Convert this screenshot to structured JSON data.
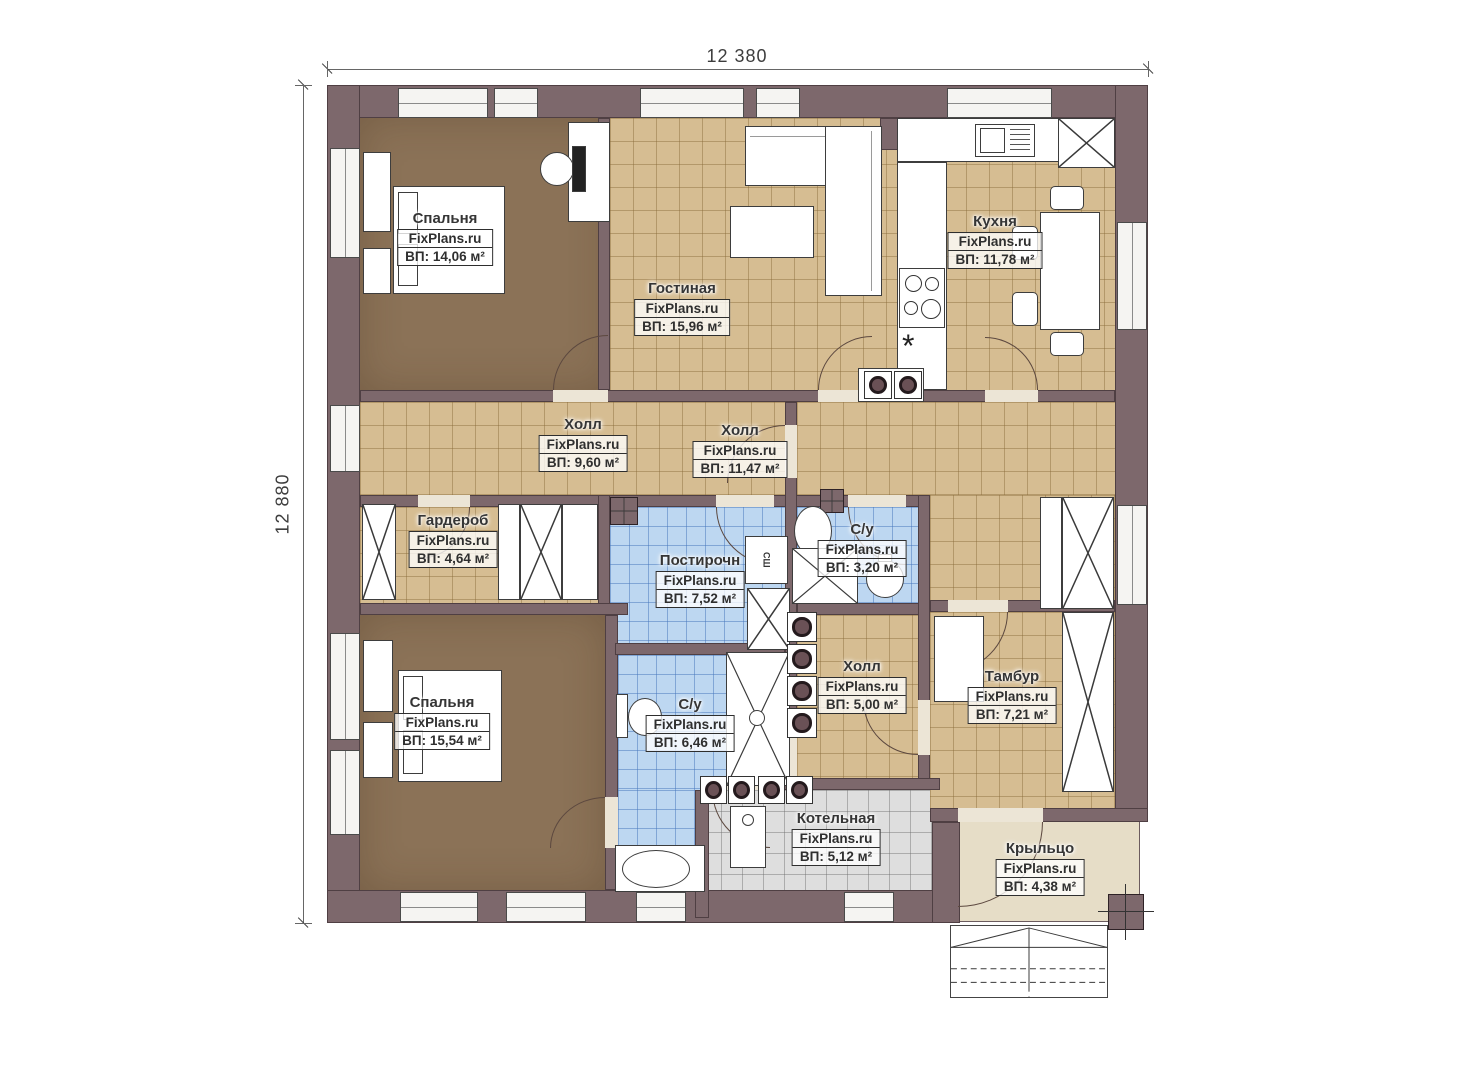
{
  "watermark": "FixPlans.ru",
  "dimensions": {
    "width_top": "12 380",
    "height_left": "12 880"
  },
  "rooms": [
    {
      "id": "bedroom-1",
      "name": "Спальня",
      "area": "ВП: 14,06 м²"
    },
    {
      "id": "living-room",
      "name": "Гостиная",
      "area": "ВП: 15,96 м²"
    },
    {
      "id": "kitchen",
      "name": "Кухня",
      "area": "ВП: 11,78 м²"
    },
    {
      "id": "hall-1",
      "name": "Холл",
      "area": "ВП: 9,60 м²"
    },
    {
      "id": "hall-2",
      "name": "Холл",
      "area": "ВП: 11,47 м²"
    },
    {
      "id": "wardrobe",
      "name": "Гардероб",
      "area": "ВП: 4,64 м²"
    },
    {
      "id": "laundry",
      "name": "Постирочн",
      "area": "ВП: 7,52 м²"
    },
    {
      "id": "bathroom-1",
      "name": "С/у",
      "area": "ВП: 3,20 м²"
    },
    {
      "id": "bedroom-2",
      "name": "Спальня",
      "area": "ВП: 15,54 м²"
    },
    {
      "id": "bathroom-2",
      "name": "С/у",
      "area": "ВП: 6,46 м²"
    },
    {
      "id": "hall-3",
      "name": "Холл",
      "area": "ВП: 5,00 м²"
    },
    {
      "id": "vestibule",
      "name": "Тамбур",
      "area": "ВП: 7,21 м²"
    },
    {
      "id": "boiler-room",
      "name": "Котельная",
      "area": "ВП: 5,12 м²"
    },
    {
      "id": "porch",
      "name": "Крыльцо",
      "area": "ВП: 4,38 м²"
    }
  ],
  "appliances": {
    "dryer_label": "СШ"
  },
  "symbols": {
    "vent": "*"
  },
  "colors": {
    "wall": "#7d686c",
    "tile_tan": "#d6bd92",
    "tile_blue": "#bdd7f1",
    "tile_gray": "#dedede",
    "carpet": "#8b7257",
    "porch": "#e6ddc7"
  }
}
